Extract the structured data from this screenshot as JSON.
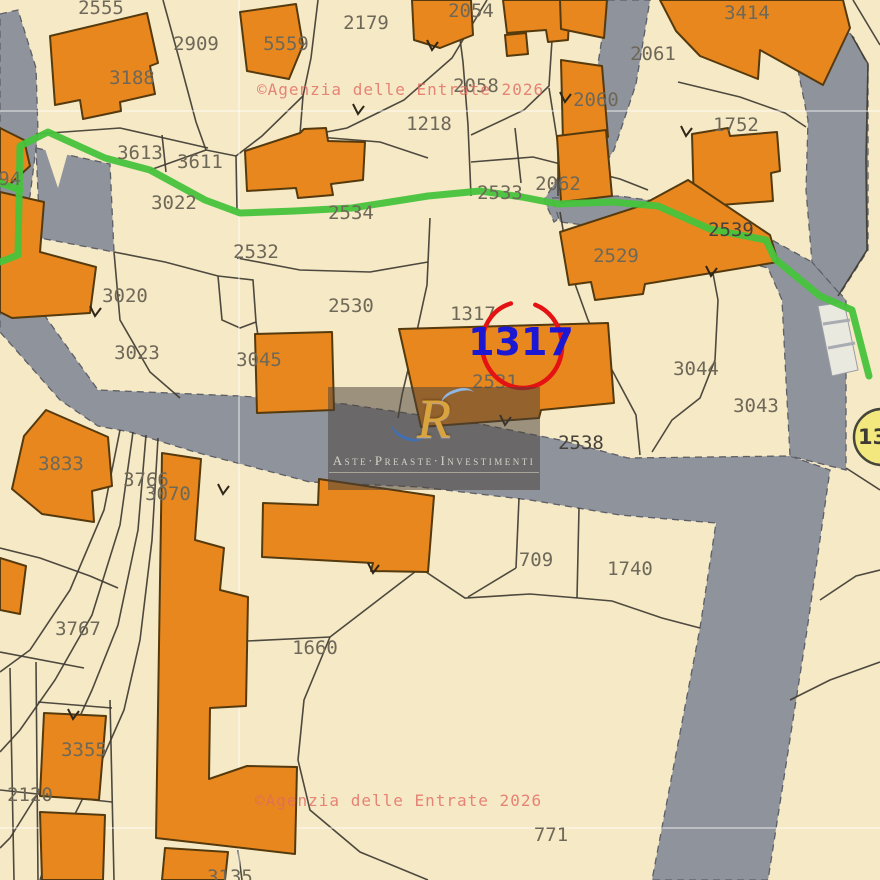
{
  "map": {
    "colors": {
      "background_beige": "#f6e9c6",
      "road_gray": "#8f939c",
      "building_orange": "#e8871e",
      "building_outline": "#553a0e",
      "parcel_line": "#3f3b32",
      "green_boundary": "#46c33c",
      "highlight_ring_red": "#e41212",
      "highlight_number_blue": "#1b17d3",
      "marker_yellow": "#f2e87d",
      "watermark_red": "#e26a60",
      "label_gray": "#6e6859"
    },
    "roads": [
      "0,14 18,10 36,68 38,132 30,196 16,228 0,234",
      "36,148 110,164 114,252 40,238",
      "0,278 22,284 98,390 240,396 345,404 480,424 560,440 628,458 790,456 830,470 807,630 768,880 652,880 700,628 716,523 620,515 530,500 420,487 310,482 195,452 130,432 98,426 60,400 0,332",
      "608,0 650,0 636,84 614,150 578,205 554,222 544,200 582,140 597,70",
      "552,198 620,196 660,202 705,222 772,240 812,262 846,300 846,372 846,470 790,456 786,380 782,300 768,268 700,250 640,232 560,222",
      "790,28 830,12 854,38 868,66 868,250 840,294 812,262 806,190 808,120 796,60"
    ],
    "beige_patches": [
      "44,146 68,152 58,188"
    ],
    "crosswalk": {
      "points": "818,306 844,302 858,370 832,376",
      "stripes": [
        "823,324 850,320",
        "828,348 855,343"
      ]
    },
    "graticule": {
      "vertical": [
        239
      ],
      "horizontal": [
        111,
        828
      ]
    },
    "boundaries": [
      "163,0 180,62 196,122 206,150",
      "206,150 150,170",
      "206,150 236,156",
      "318,0 311,58 303,96 300,134",
      "303,96 262,136 236,156",
      "487,0 452,58 404,100 347,128 306,136",
      "455,0 463,62 468,125 471,196",
      "471,135 524,110 549,86 552,40 549,0",
      "549,88 558,145 558,196",
      "471,162 533,157 620,179 648,190",
      "515,128 521,183",
      "236,156 237,210",
      "114,252 165,262 218,276",
      "218,276 253,280 256,322 240,328 222,320 218,276",
      "237,258 300,270 370,272 428,262",
      "256,322 258,336",
      "430,218 427,285 415,340 402,395 398,418",
      "560,212 570,270 588,320 612,370 636,415 640,455",
      "652,452 672,420 700,398 715,360 718,300 712,268",
      "330,637 420,568 465,598 530,594 578,598 612,601 662,618 700,628",
      "330,637 304,700 298,760 310,810 360,852 428,880",
      "330,637 247,641",
      "519,498 516,568",
      "579,508 577,598",
      "516,568 468,597",
      "419,500 421,568",
      "36,134 120,128 208,148",
      "162,135 166,172",
      "306,136 380,142 428,158",
      "114,252 120,320 150,372 180,398",
      "0,548 40,558 90,576 118,588",
      "120,430 104,510 70,590 30,650 0,672",
      "133,432 120,525 92,615 55,680 20,730 0,752",
      "146,435 138,530 118,625 92,690 70,738 40,790 10,838 0,848",
      "158,438 152,540 140,640 124,710 102,760 72,820 44,868 40,880",
      "10,668 14,880",
      "36,662 38,880",
      "0,790 112,802",
      "110,700 114,880",
      "38,702 112,708",
      "0,652 84,668",
      "846,468 880,490",
      "820,600 856,576 880,570",
      "790,700 830,680 880,662",
      "853,0 880,45",
      "852,36 868,64 866,160 867,250 838,296",
      "678,82 740,97 785,113 806,127",
      "238,850 242,880"
    ],
    "buildings": [
      "50,36 147,13 158,63 150,66 155,94 120,102 121,111 83,119 80,100 55,105",
      "240,12 296,4 303,45 289,79 247,71",
      "412,0 471,0 473,35 440,48 414,40",
      "503,0 570,0 568,40 548,42 546,30 507,33",
      "505,35 526,33 528,54 507,56",
      "245,151 300,133 304,129 326,128 328,141 365,142 363,180 331,184 333,195 298,198 296,188 247,191",
      "0,128 24,140 30,166 8,186 0,183",
      "0,192 44,202 40,252 96,267 90,313 12,318 0,312",
      "560,0 607,0 604,38 561,29",
      "561,60 602,66 608,137 563,142",
      "557,136 606,130 612,196 561,202",
      "660,0 843,0 850,28 823,85 760,50 758,79 700,56 676,31",
      "692,134 728,128 730,136 777,132 780,171 771,173 773,201 694,207",
      "560,232 640,206 688,180 770,235 778,262 645,284 643,294 595,300 591,282 569,285",
      "255,334 332,332 334,410 257,413",
      "399,329 608,323 614,403 541,410 539,418 421,427",
      "319,479 434,496 428,572 371,571 373,563 262,557 263,503 318,505",
      "162,453 201,459 195,540 224,548 220,590 248,597 246,706 210,708 209,779 247,766 297,767 295,854 156,838",
      "165,848 228,852 225,880 162,880",
      "44,713 106,716 99,800 40,796",
      "40,812 105,815 103,880 42,880",
      "0,558 26,566 20,614 0,610",
      "46,410 108,437 112,486 92,491 94,522 42,514 12,489 24,436"
    ],
    "ticks": [
      "353,104 358,114 364,106",
      "427,40 432,50 438,42",
      "681,126 686,136 692,128",
      "500,415 505,425 511,417",
      "368,563 373,573 379,565",
      "218,484 223,494 229,486",
      "90,306 95,316 101,308",
      "68,709 73,719 79,711",
      "706,266 711,276 717,268",
      "560,92 565,102 571,94"
    ],
    "green_boundary": [
      "0,262 18,255 20,146 48,132 105,158 150,170 205,200 240,213 295,211 352,208 428,196 480,191 522,197 558,204 612,202 658,206 710,229 766,240 775,259 820,296 852,310 869,376",
      "20,190 0,183"
    ],
    "parcel_labels": [
      {
        "text": "2555",
        "x": 101,
        "y": 8
      },
      {
        "text": "2909",
        "x": 196,
        "y": 44
      },
      {
        "text": "5559",
        "x": 286,
        "y": 44
      },
      {
        "text": "3188",
        "x": 132,
        "y": 78
      },
      {
        "text": "2179",
        "x": 366,
        "y": 23
      },
      {
        "text": "2054",
        "x": 471,
        "y": 11
      },
      {
        "text": "2058",
        "x": 476,
        "y": 86
      },
      {
        "text": "2060",
        "x": 596,
        "y": 100
      },
      {
        "text": "2061",
        "x": 653,
        "y": 54
      },
      {
        "text": "3414",
        "x": 747,
        "y": 13
      },
      {
        "text": "1752",
        "x": 736,
        "y": 125
      },
      {
        "text": "1218",
        "x": 429,
        "y": 124
      },
      {
        "text": "2062",
        "x": 558,
        "y": 184
      },
      {
        "text": "2533",
        "x": 500,
        "y": 193
      },
      {
        "text": "2534",
        "x": 351,
        "y": 213
      },
      {
        "text": "3022",
        "x": 174,
        "y": 203
      },
      {
        "text": "3613",
        "x": 140,
        "y": 153
      },
      {
        "text": "3611",
        "x": 200,
        "y": 162
      },
      {
        "text": "494",
        "x": 4,
        "y": 179
      },
      {
        "text": "2532",
        "x": 256,
        "y": 252
      },
      {
        "text": "3020",
        "x": 125,
        "y": 296
      },
      {
        "text": "2530",
        "x": 351,
        "y": 306
      },
      {
        "text": "3023",
        "x": 137,
        "y": 353
      },
      {
        "text": "3045",
        "x": 259,
        "y": 360
      },
      {
        "text": "1317",
        "x": 473,
        "y": 314
      },
      {
        "text": "2531",
        "x": 495,
        "y": 382
      },
      {
        "text": "2529",
        "x": 616,
        "y": 256
      },
      {
        "text": "2539",
        "x": 731,
        "y": 230,
        "dark": true
      },
      {
        "text": "3044",
        "x": 696,
        "y": 369
      },
      {
        "text": "3043",
        "x": 756,
        "y": 406
      },
      {
        "text": "2538",
        "x": 581,
        "y": 443,
        "dark": true
      },
      {
        "text": "3766",
        "x": 146,
        "y": 480
      },
      {
        "text": "3070",
        "x": 168,
        "y": 494
      },
      {
        "text": "3833",
        "x": 61,
        "y": 464
      },
      {
        "text": "3767",
        "x": 78,
        "y": 629
      },
      {
        "text": "1660",
        "x": 315,
        "y": 648
      },
      {
        "text": "709",
        "x": 536,
        "y": 560
      },
      {
        "text": "1740",
        "x": 630,
        "y": 569
      },
      {
        "text": "771",
        "x": 551,
        "y": 835
      },
      {
        "text": "3355",
        "x": 84,
        "y": 750
      },
      {
        "text": "2120",
        "x": 30,
        "y": 795
      },
      {
        "text": "3135",
        "x": 230,
        "y": 877
      }
    ],
    "watermarks": [
      {
        "text": "©Agenzia delle Entrate 2026",
        "x": 257,
        "y": 95
      },
      {
        "text": "©Agenzia delle Entrate 2026",
        "x": 255,
        "y": 806
      }
    ],
    "highlight": {
      "text": "1317",
      "cx": 522,
      "cy": 345,
      "rx": 40,
      "ry": 43,
      "rotate": -8,
      "text_x": 521,
      "text_y": 355
    },
    "marker": {
      "text": "13",
      "cx": 882,
      "cy": 437,
      "r": 28,
      "text_x": 858,
      "text_y": 444
    },
    "logo": {
      "monogram": "R",
      "caption": "Aste·Preaste·Investimenti"
    }
  }
}
